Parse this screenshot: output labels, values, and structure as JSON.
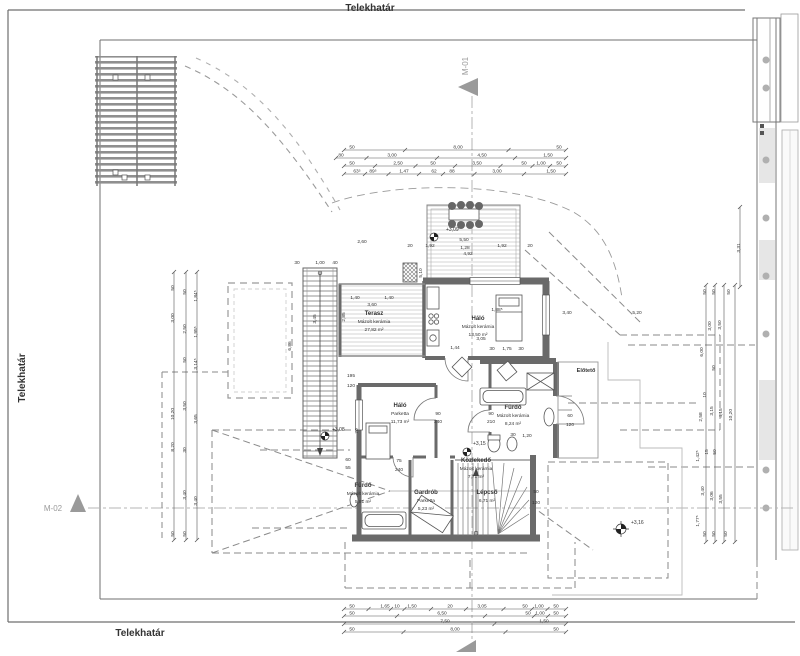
{
  "sheet": {
    "type": "architectural floor plan",
    "language": "hu"
  },
  "labels": [
    {
      "n": "boundary-label-top",
      "x": 370,
      "y": 11,
      "t": "Telekhatár",
      "s": 10,
      "b": 1,
      "a": "middle"
    },
    {
      "n": "boundary-label-bottom",
      "x": 140,
      "y": 636,
      "t": "Telekhatár",
      "s": 10,
      "b": 1,
      "a": "middle"
    },
    {
      "n": "boundary-label-left",
      "x": 25,
      "y": 378,
      "t": "Telekhatár",
      "s": 10,
      "b": 1,
      "a": "middle",
      "r": -90
    },
    {
      "n": "section-label-m01",
      "x": 468,
      "y": 66,
      "t": "M-01",
      "s": 8,
      "c": "#9a9a9a",
      "a": "middle",
      "r": -90
    },
    {
      "n": "section-label-m02",
      "x": 53,
      "y": 511,
      "t": "M-02",
      "s": 8,
      "c": "#9a9a9a",
      "a": "middle"
    },
    {
      "n": "level-upper-terrace",
      "x": 446,
      "y": 231,
      "t": "+3,09",
      "s": 5,
      "a": "start"
    },
    {
      "n": "level-lower-deck",
      "x": 332,
      "y": 431,
      "t": "+3,08",
      "s": 5,
      "a": "start"
    },
    {
      "n": "level-entry",
      "x": 473,
      "y": 445,
      "t": "+3,15",
      "s": 5,
      "a": "start"
    },
    {
      "n": "level-roof",
      "x": 631,
      "y": 524,
      "t": "+3,16",
      "s": 5,
      "a": "start"
    }
  ],
  "rooms": [
    {
      "name": "Terasz",
      "material": "Mázolt kerámia",
      "area": "27,82 m²",
      "cx": 374,
      "cy": 315
    },
    {
      "name": "Háló",
      "material": "Mázolt kerámia",
      "area": "13,50 m²",
      "cx": 478,
      "cy": 320
    },
    {
      "name": "Háló",
      "material": "Parketta",
      "area": "11,73 m²",
      "cx": 400,
      "cy": 407
    },
    {
      "name": "Fürdő",
      "material": "Mázolt kerámia",
      "area": "8,24 m²",
      "cx": 513,
      "cy": 409
    },
    {
      "name": "Közlekedő",
      "material": "Mázolt kerámia",
      "area": "7,71 m²",
      "cx": 476,
      "cy": 462
    },
    {
      "name": "Fürdő",
      "material": "Mázolt kerámia",
      "area": "5,81 m²",
      "cx": 363,
      "cy": 487
    },
    {
      "name": "Gardrób",
      "material": "Parketta",
      "area": "5,23 m²",
      "cx": 426,
      "cy": 494
    },
    {
      "name": "Lépcső",
      "material": "",
      "area": "6,71 m²",
      "cx": 487,
      "cy": 494
    },
    {
      "name": "Előtető",
      "material": "",
      "area": "",
      "cx": 586,
      "cy": 372,
      "ns": 5.5
    }
  ],
  "dim_chains": {
    "horizontal": [
      {
        "y": 150,
        "x1": 344,
        "x2": 566,
        "items": [
          {
            "x": 352,
            "t": "50"
          },
          {
            "x": 458,
            "t": "8,00"
          },
          {
            "x": 559,
            "t": "50"
          }
        ]
      },
      {
        "y": 158,
        "x1": 336,
        "x2": 566,
        "items": [
          {
            "x": 341,
            "t": "80"
          },
          {
            "x": 392,
            "t": "3,00"
          },
          {
            "x": 482,
            "t": "4,50"
          },
          {
            "x": 548,
            "t": "1,50"
          }
        ]
      },
      {
        "y": 166,
        "x1": 344,
        "x2": 566,
        "items": [
          {
            "x": 352,
            "t": "50"
          },
          {
            "x": 398,
            "t": "2,50"
          },
          {
            "x": 433,
            "t": "50"
          },
          {
            "x": 477,
            "t": "3,50"
          },
          {
            "x": 524,
            "t": "50"
          },
          {
            "x": 541,
            "t": "1,00"
          },
          {
            "x": 559,
            "t": "50"
          }
        ]
      },
      {
        "y": 174,
        "x1": 344,
        "x2": 566,
        "items": [
          {
            "x": 357,
            "t": "63⁵"
          },
          {
            "x": 373,
            "t": "89⁵"
          },
          {
            "x": 404,
            "t": "1,47"
          },
          {
            "x": 434,
            "t": "62"
          },
          {
            "x": 452,
            "t": "88"
          },
          {
            "x": 497,
            "t": "3,00"
          },
          {
            "x": 551,
            "t": "1,50"
          }
        ]
      },
      {
        "y": 609,
        "x1": 344,
        "x2": 566,
        "items": [
          {
            "x": 352,
            "t": "50"
          },
          {
            "x": 385,
            "t": "1,65"
          },
          {
            "x": 397,
            "t": "10"
          },
          {
            "x": 412,
            "t": "1,50"
          },
          {
            "x": 450,
            "t": "20"
          },
          {
            "x": 482,
            "t": "3,05"
          },
          {
            "x": 525,
            "t": "50"
          },
          {
            "x": 539,
            "t": "1,00"
          },
          {
            "x": 556,
            "t": "50"
          }
        ]
      },
      {
        "y": 616,
        "x1": 344,
        "x2": 566,
        "items": [
          {
            "x": 352,
            "t": "50"
          },
          {
            "x": 442,
            "t": "6,50"
          },
          {
            "x": 528,
            "t": "50"
          },
          {
            "x": 540,
            "t": "1,00"
          },
          {
            "x": 556,
            "t": "50"
          }
        ]
      },
      {
        "y": 624,
        "x1": 344,
        "x2": 566,
        "items": [
          {
            "x": 445,
            "t": "7,50"
          },
          {
            "x": 544,
            "t": "1,50"
          }
        ]
      },
      {
        "y": 632,
        "x1": 344,
        "x2": 566,
        "items": [
          {
            "x": 352,
            "t": "50"
          },
          {
            "x": 455,
            "t": "8,00"
          },
          {
            "x": 556,
            "t": "50"
          }
        ]
      }
    ],
    "vertical_lines": [
      {
        "x": 174,
        "y1": 272,
        "y2": 540
      },
      {
        "x": 186,
        "y1": 272,
        "y2": 540
      },
      {
        "x": 197,
        "y1": 272,
        "y2": 540
      },
      {
        "x": 706,
        "y1": 285,
        "y2": 542
      },
      {
        "x": 715,
        "y1": 285,
        "y2": 542
      },
      {
        "x": 724,
        "y1": 285,
        "y2": 542
      },
      {
        "x": 735,
        "y1": 285,
        "y2": 542
      },
      {
        "x": 740,
        "y1": 207,
        "y2": 287
      }
    ],
    "vertical_labels": [
      {
        "x": 174,
        "y": 288,
        "t": "50"
      },
      {
        "x": 174,
        "y": 318,
        "t": "3,00"
      },
      {
        "x": 174,
        "y": 414,
        "t": "10,20"
      },
      {
        "x": 174,
        "y": 447,
        "t": "8,20"
      },
      {
        "x": 174,
        "y": 534,
        "t": "50"
      },
      {
        "x": 186,
        "y": 292,
        "t": "50"
      },
      {
        "x": 186,
        "y": 329,
        "t": "2,50"
      },
      {
        "x": 186,
        "y": 360,
        "t": "50"
      },
      {
        "x": 186,
        "y": 406,
        "t": "3,50"
      },
      {
        "x": 186,
        "y": 450,
        "t": "30"
      },
      {
        "x": 186,
        "y": 495,
        "t": "3,40"
      },
      {
        "x": 186,
        "y": 534,
        "t": "50"
      },
      {
        "x": 197,
        "y": 296,
        "t": "1,84⁵"
      },
      {
        "x": 197,
        "y": 332,
        "t": "1,95⁵"
      },
      {
        "x": 197,
        "y": 364,
        "t": "3,14⁵"
      },
      {
        "x": 197,
        "y": 419,
        "t": "3,65"
      },
      {
        "x": 197,
        "y": 501,
        "t": "3,40"
      },
      {
        "x": 706,
        "y": 292,
        "t": "50"
      },
      {
        "x": 715,
        "y": 292,
        "t": "50"
      },
      {
        "x": 730,
        "y": 292,
        "t": "50"
      },
      {
        "x": 711,
        "y": 326,
        "t": "3,00"
      },
      {
        "x": 721,
        "y": 325,
        "t": "3,50"
      },
      {
        "x": 703,
        "y": 352,
        "t": "6,00"
      },
      {
        "x": 715,
        "y": 368,
        "t": "50"
      },
      {
        "x": 706,
        "y": 395,
        "t": "10"
      },
      {
        "x": 702,
        "y": 417,
        "t": "2,58"
      },
      {
        "x": 713,
        "y": 411,
        "t": "3,15"
      },
      {
        "x": 722,
        "y": 413,
        "t": "4,15"
      },
      {
        "x": 732,
        "y": 415,
        "t": "10,20"
      },
      {
        "x": 699,
        "y": 456,
        "t": "1,42⁵"
      },
      {
        "x": 708,
        "y": 452,
        "t": "15"
      },
      {
        "x": 716,
        "y": 452,
        "t": "50"
      },
      {
        "x": 704,
        "y": 491,
        "t": "3,40"
      },
      {
        "x": 713,
        "y": 496,
        "t": "3,06"
      },
      {
        "x": 722,
        "y": 499,
        "t": "3,55"
      },
      {
        "x": 699,
        "y": 521,
        "t": "1,77⁵"
      },
      {
        "x": 706,
        "y": 534,
        "t": "50"
      },
      {
        "x": 715,
        "y": 534,
        "t": "50"
      },
      {
        "x": 727,
        "y": 534,
        "t": "50"
      },
      {
        "x": 740,
        "y": 248,
        "t": "3,31"
      }
    ],
    "misc": [
      {
        "x": 362,
        "y": 243,
        "t": "2,60"
      },
      {
        "x": 410,
        "y": 247,
        "t": "20"
      },
      {
        "x": 430,
        "y": 247,
        "t": "1,92"
      },
      {
        "x": 464,
        "y": 241,
        "t": "5,50"
      },
      {
        "x": 465,
        "y": 249,
        "t": "1,28"
      },
      {
        "x": 502,
        "y": 247,
        "t": "1,92"
      },
      {
        "x": 468,
        "y": 255,
        "t": "4,92"
      },
      {
        "x": 530,
        "y": 247,
        "t": "20"
      },
      {
        "x": 355,
        "y": 299,
        "t": "1,40"
      },
      {
        "x": 389,
        "y": 299,
        "t": "1,40"
      },
      {
        "x": 372,
        "y": 306,
        "t": "3,60"
      },
      {
        "x": 345,
        "y": 317,
        "t": "2,85",
        "r": -90
      },
      {
        "x": 291,
        "y": 346,
        "t": "6,86",
        "r": -90
      },
      {
        "x": 316,
        "y": 319,
        "t": "3,45",
        "r": -90
      },
      {
        "x": 422,
        "y": 273,
        "t": "5,10",
        "r": -90
      },
      {
        "x": 358,
        "y": 431,
        "t": "70",
        "r": -90
      },
      {
        "x": 297,
        "y": 264,
        "t": "30"
      },
      {
        "x": 320,
        "y": 264,
        "t": "1,00"
      },
      {
        "x": 335,
        "y": 264,
        "t": "40"
      },
      {
        "x": 351,
        "y": 377,
        "t": "195"
      },
      {
        "x": 351,
        "y": 387,
        "t": "120"
      },
      {
        "x": 497,
        "y": 311,
        "t": "1,88⁵"
      },
      {
        "x": 481,
        "y": 340,
        "t": "3,05"
      },
      {
        "x": 455,
        "y": 349,
        "t": "1,44"
      },
      {
        "x": 492,
        "y": 350,
        "t": "30"
      },
      {
        "x": 507,
        "y": 350,
        "t": "1,75"
      },
      {
        "x": 521,
        "y": 350,
        "t": "30"
      },
      {
        "x": 567,
        "y": 314,
        "t": "3,40"
      },
      {
        "x": 637,
        "y": 314,
        "t": "5,20"
      },
      {
        "x": 491,
        "y": 415,
        "t": "90"
      },
      {
        "x": 491,
        "y": 423,
        "t": "210"
      },
      {
        "x": 513,
        "y": 436,
        "t": "30"
      },
      {
        "x": 527,
        "y": 437,
        "t": "1,20"
      },
      {
        "x": 570,
        "y": 417,
        "t": "60"
      },
      {
        "x": 570,
        "y": 426,
        "t": "120"
      },
      {
        "x": 438,
        "y": 415,
        "t": "90"
      },
      {
        "x": 438,
        "y": 423,
        "t": "240"
      },
      {
        "x": 399,
        "y": 462,
        "t": "75"
      },
      {
        "x": 399,
        "y": 471,
        "t": "240"
      },
      {
        "x": 536,
        "y": 493,
        "t": "50"
      },
      {
        "x": 536,
        "y": 504,
        "t": "120"
      },
      {
        "x": 348,
        "y": 461,
        "t": "60"
      },
      {
        "x": 348,
        "y": 469,
        "t": "55"
      }
    ]
  },
  "colors": {
    "line": "#555555",
    "wall": "#6a6a6a",
    "dash": "#8a8a8a",
    "marker": "#9a9a9a",
    "deck": "#c4c4c4",
    "text": "#333333"
  }
}
